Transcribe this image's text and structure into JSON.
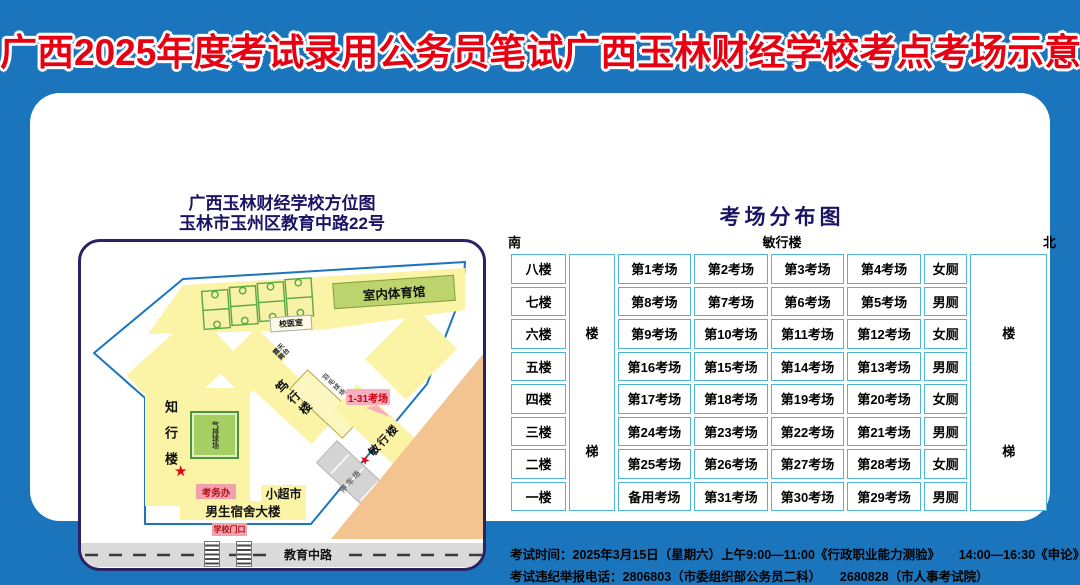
{
  "page_title": "广西2025年度考试录用公务员笔试广西玉林财经学校考点考场示意图",
  "map": {
    "title_line1": "广西玉林财经学校方位图",
    "title_line2": "玉林市玉州区教育中路22号",
    "gym": "室内体育馆",
    "clinic": "校医室",
    "stage": "露天舞台",
    "building_duxing": "笃行楼",
    "badminton": "羽毛球场",
    "exam_rooms_callout": "1-31考场",
    "building_minxing": "敏行楼",
    "parking": "停车场",
    "building_zhixing": "知行楼",
    "volleyball": "气排球场",
    "exam_office": "考务办",
    "supermarket": "小超市",
    "dormitory": "男生宿舍大楼",
    "school_gate": "学校门口",
    "road": "教育中路",
    "star": "★"
  },
  "table": {
    "title": "考场分布图",
    "south": "南",
    "building": "敏行楼",
    "north": "北",
    "stair_char_top": "楼",
    "stair_char_bottom": "梯",
    "rows": [
      {
        "floor": "八楼",
        "rooms": [
          "第1考场",
          "第2考场",
          "第3考场",
          "第4考场"
        ],
        "toilet": "女厕"
      },
      {
        "floor": "七楼",
        "rooms": [
          "第8考场",
          "第7考场",
          "第6考场",
          "第5考场"
        ],
        "toilet": "男厕"
      },
      {
        "floor": "六楼",
        "rooms": [
          "第9考场",
          "第10考场",
          "第11考场",
          "第12考场"
        ],
        "toilet": "女厕"
      },
      {
        "floor": "五楼",
        "rooms": [
          "第16考场",
          "第15考场",
          "第14考场",
          "第13考场"
        ],
        "toilet": "男厕"
      },
      {
        "floor": "四楼",
        "rooms": [
          "第17考场",
          "第18考场",
          "第19考场",
          "第20考场"
        ],
        "toilet": "女厕"
      },
      {
        "floor": "三楼",
        "rooms": [
          "第24考场",
          "第23考场",
          "第22考场",
          "第21考场"
        ],
        "toilet": "男厕"
      },
      {
        "floor": "二楼",
        "rooms": [
          "第25考场",
          "第26考场",
          "第27考场",
          "第28考场"
        ],
        "toilet": "女厕"
      },
      {
        "floor": "一楼",
        "rooms": [
          "备用考场",
          "第31考场",
          "第30考场",
          "第29考场"
        ],
        "toilet": "男厕"
      }
    ]
  },
  "notes": {
    "line1": "考试时间：2025年3月15日（星期六）上午9:00—11:00《行政职业能力测验》　　14:00—16:30《申论》",
    "line2": "考试违纪举报电话：2806803（市委组织部公务员二科）　　2680828（市人事考试院）"
  },
  "colors": {
    "page_bg": "#1B75BC",
    "title_red": "#E60012",
    "navy": "#1B1464",
    "table_border": "#4FB3DE",
    "campus_outline": "#1C75BC",
    "building_yellow": "#FBF3A6",
    "green_court": "#A5CF63",
    "pink_label": "#F2A0AC",
    "orange_zone": "#F3C390"
  }
}
